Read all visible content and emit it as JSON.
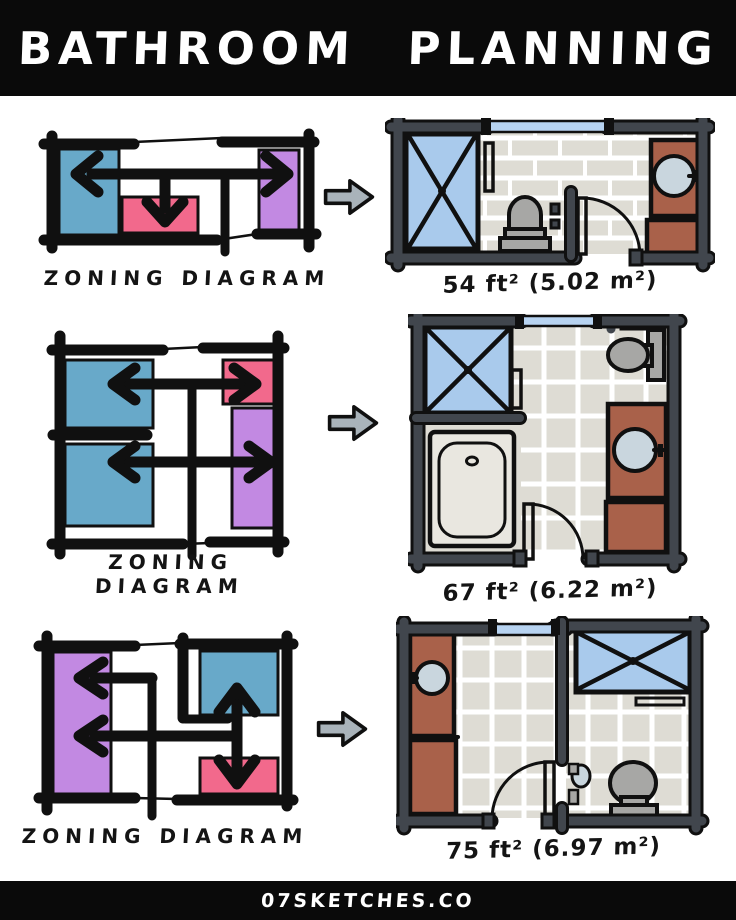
{
  "header": {
    "title": "BATHROOM PLANNING"
  },
  "footer": {
    "site": "07SKETCHES.CO"
  },
  "rows": [
    {
      "zoning_label": "ZONING DIAGRAM",
      "area_label": "54 ft² (5.02 m²)",
      "area_ft2": 54,
      "area_m2": 5.02,
      "zones": [
        {
          "color_key": "teal",
          "arrow": "left"
        },
        {
          "color_key": "pink",
          "arrow": "down"
        },
        {
          "color_key": "purple",
          "arrow": "right"
        }
      ],
      "plan_fixtures": [
        "shower",
        "toilet",
        "vanity sink",
        "door",
        "window",
        "towel bar"
      ]
    },
    {
      "zoning_label": "ZONING DIAGRAM",
      "area_label": "67 ft² (6.22 m²)",
      "area_ft2": 67,
      "area_m2": 6.22,
      "zones": [
        {
          "color_key": "teal",
          "arrow": "left"
        },
        {
          "color_key": "teal",
          "arrow": "left"
        },
        {
          "color_key": "pink",
          "arrow": "right"
        },
        {
          "color_key": "purple",
          "arrow": "right"
        }
      ],
      "plan_fixtures": [
        "shower",
        "bathtub",
        "toilet",
        "vanity sink",
        "door",
        "window",
        "towel bar"
      ]
    },
    {
      "zoning_label": "ZONING DIAGRAM",
      "area_label": "75 ft² (6.97 m²)",
      "area_ft2": 75,
      "area_m2": 6.97,
      "zones": [
        {
          "color_key": "purple",
          "arrow": "left"
        },
        {
          "color_key": "teal",
          "arrow": "up"
        },
        {
          "color_key": "pink",
          "arrow": "down"
        }
      ],
      "plan_fixtures": [
        "shower",
        "toilet",
        "vanity sink",
        "small sink",
        "door",
        "window",
        "towel bar"
      ]
    }
  ],
  "colors": {
    "ink": "#101010",
    "teal": "#68a9c9",
    "pink": "#f2698c",
    "purple": "#c289e2",
    "arrow": "#a9b3ba",
    "wall": "#41464d",
    "tile": "#dedcd4",
    "grout": "#ffffff",
    "shower": "#a9caec",
    "vanity": "#a9614a",
    "fixture": "#a7a7a5",
    "tub": "#e9e7e0",
    "sink": "#c9d6de",
    "window": "#b7d3f1"
  }
}
